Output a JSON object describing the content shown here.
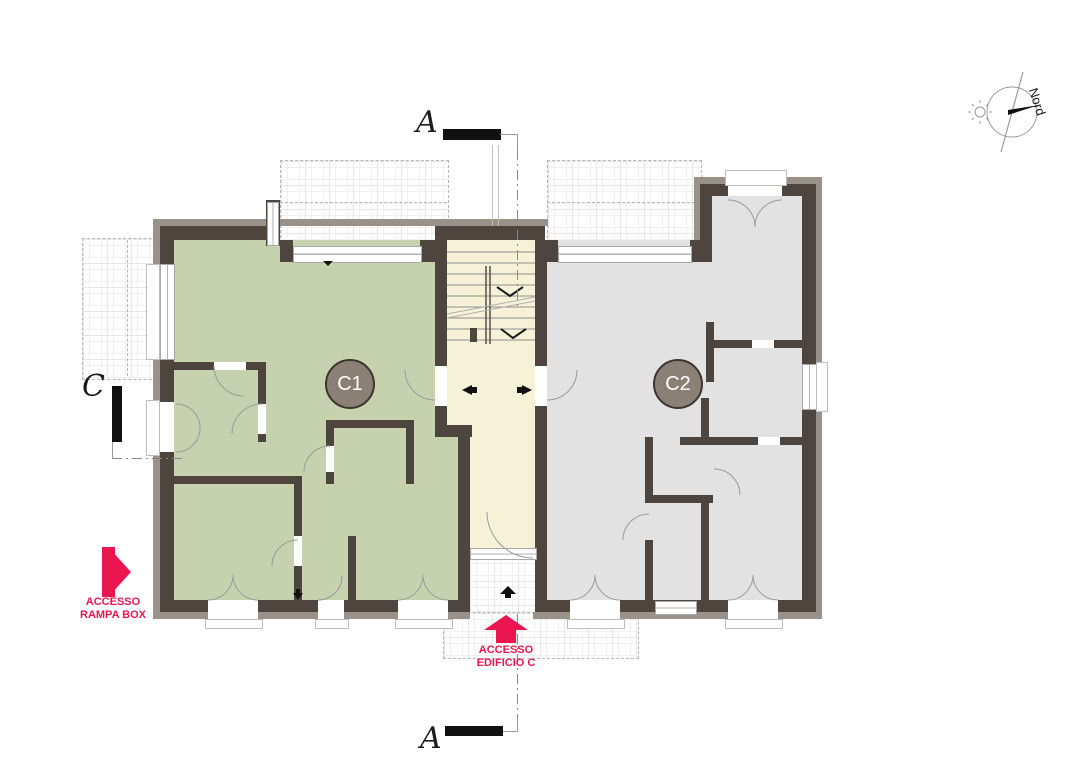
{
  "plan": {
    "section_markers": {
      "top": "A",
      "bottom": "A",
      "left": "C"
    },
    "compass": {
      "label": "Nord"
    },
    "units": {
      "c1": {
        "label": "C1",
        "floor_color": "#c6d2ae"
      },
      "c2": {
        "label": "C2",
        "floor_color": "#e2e2e3"
      }
    },
    "stairwell": {
      "floor_color": "#f6f2d8"
    },
    "annotations": {
      "rampa_box": {
        "line1": "ACCESSO",
        "line2": "RAMPA BOX",
        "arrow": "right"
      },
      "edificio_c": {
        "line1": "ACCESSO",
        "line2": "EDIFICIO C",
        "arrow": "up"
      }
    },
    "colors": {
      "wall_dark": "#4e463e",
      "wall_outer": "#9a9188",
      "accent_red": "#eb1650",
      "unit_badge": "#8b8076"
    }
  }
}
